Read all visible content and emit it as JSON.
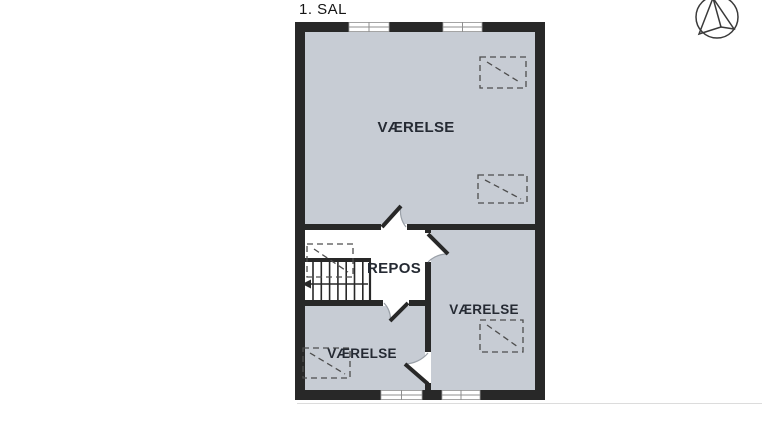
{
  "title": "1. SAL",
  "rooms": {
    "room_top": {
      "label": "VÆRELSE"
    },
    "landing": {
      "label": "REPOS"
    },
    "room_bottom_left": {
      "label": "VÆRELSE"
    },
    "room_bottom_right": {
      "label": "VÆRELSE"
    }
  },
  "icons": {
    "compass": "north-compass-icon",
    "skylight": "roof-window-symbol",
    "stairs": "staircase-symbol"
  },
  "colors": {
    "wall": "#282828",
    "room_fill": "#c7ccd4",
    "label_text": "#252a33",
    "door_arc": "#9aa0a8",
    "dashed_symbol": "#4d4d4d",
    "window_frame": "#8f8f8f"
  }
}
